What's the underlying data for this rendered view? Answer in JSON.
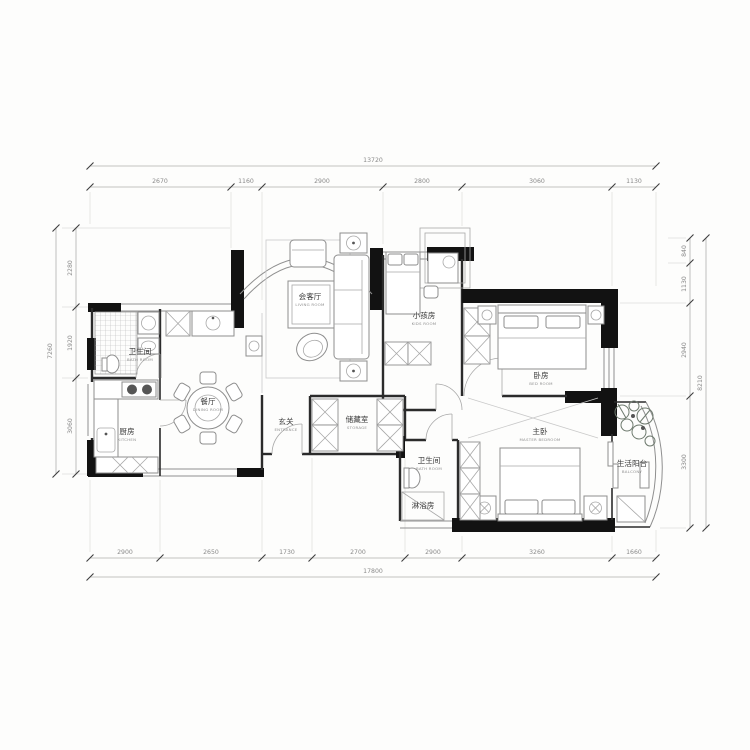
{
  "drawing": {
    "type": "residential-floor-plan"
  },
  "colors": {
    "wall_fill": "#121212",
    "wall_line": "#2b2b2b",
    "furniture_line": "#8e8e8e",
    "dim_text": "#8a8a8a",
    "label_text": "#3a3a3a",
    "plant_line": "#6e7a6e"
  },
  "rooms": [
    {
      "id": "living",
      "zh": "会客厅",
      "en": "LIVING ROOM"
    },
    {
      "id": "kids",
      "zh": "小孩房",
      "en": "KIDS ROOM"
    },
    {
      "id": "bedroom",
      "zh": "卧房",
      "en": "BED ROOM"
    },
    {
      "id": "master",
      "zh": "主卧",
      "en": "MASTER BEDROOM"
    },
    {
      "id": "bath1",
      "zh": "卫生间",
      "en": "BATH ROOM"
    },
    {
      "id": "kitchen",
      "zh": "厨房",
      "en": "KITCHEN"
    },
    {
      "id": "dining",
      "zh": "餐厅",
      "en": "DINING ROOM"
    },
    {
      "id": "entrance",
      "zh": "玄关",
      "en": "ENTRANCE"
    },
    {
      "id": "storage",
      "zh": "储藏室",
      "en": "STORAGE"
    },
    {
      "id": "bath2",
      "zh": "卫生间",
      "en": "BATH ROOM"
    },
    {
      "id": "shower",
      "zh": "淋浴房",
      "en": ""
    },
    {
      "id": "balcony",
      "zh": "生活阳台",
      "en": "BALCONY"
    }
  ],
  "dims": {
    "top": {
      "overall": "13720",
      "segments": [
        "2670",
        "1160",
        "2900",
        "2800",
        "3060",
        "1130"
      ]
    },
    "bottom": {
      "overall": "17800",
      "segments": [
        "2900",
        "2650",
        "1730",
        "2700",
        "2900",
        "3260",
        "1660"
      ]
    },
    "left": {
      "overall": "7260",
      "segments": [
        "2280",
        "1920",
        "3060"
      ]
    },
    "right": {
      "overall": "8210",
      "segments": [
        "840",
        "1130",
        "2940",
        "3300"
      ]
    }
  }
}
